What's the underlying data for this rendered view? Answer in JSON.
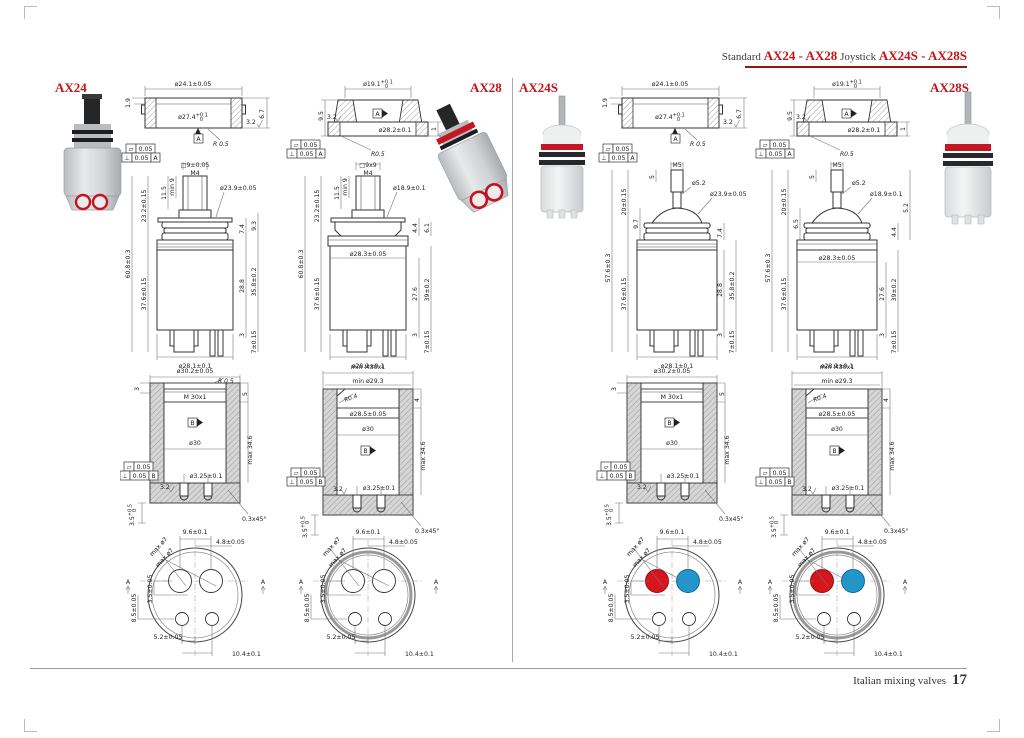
{
  "header": {
    "label_standard": "Standard",
    "models_standard": "AX24 - AX28",
    "label_joystick": "Joystick",
    "models_joystick": "AX24S - AX28S",
    "accent_color": "#c31418",
    "rule_color": "#8e1a12"
  },
  "footer": {
    "text": "Italian mixing valves",
    "page_number": "17"
  },
  "colors": {
    "hot": "#d6161d",
    "cold": "#2196cc",
    "label_red": "#c31418"
  },
  "columns": [
    {
      "model": "AX24",
      "detail": {
        "top_dia": "ø24.1±0.05",
        "inner_dia": "ø27.4",
        "inner_tol_plus": "+0.1",
        "inner_tol_minus": "0",
        "lip": "1.9",
        "finish": "3.2",
        "height": "6.7",
        "radius": "R 0.5",
        "datum": "A",
        "flatness": "0.05",
        "perp": "0.05",
        "perp_ref": "A"
      },
      "side": {
        "stem": "□9±0.05",
        "thread": "M4",
        "min_len": "min 9",
        "stem_h": "11.5",
        "upper_h": "23.2±0.15",
        "total_h": "60.8±0.3",
        "body_h": "37.6±0.15",
        "collar_dia": "ø23.9±0.05",
        "c1": "7.4",
        "c2": "9.3",
        "b1": "28.8",
        "b2": "35.8±0.2",
        "p1": "3",
        "p2": "7±0.15",
        "base_dia": "ø28.1±0.1"
      },
      "section": {
        "top_dia": "ø30.2±0.05",
        "radius": "R 0.5",
        "lip": "3",
        "thread": "M 30x1",
        "thread_h": "5",
        "datum": "B",
        "bore": "ø30",
        "depth": "max 34.6",
        "flatness": "0.05",
        "perp": "0.05",
        "perp_ref": "B",
        "finish": "3.2",
        "holes": "ø3.25±0.1",
        "chamfer": "0.3x45°",
        "foot": "3.5",
        "foot_tol_plus": "+0.5",
        "foot_tol_minus": "0"
      },
      "bottom": {
        "pitch": "9.6±0.1",
        "half_pitch": "4.8±0.05",
        "hole1": "max ø7",
        "hole2": "max ø7",
        "v1": "3.5±0.05",
        "v2": "8.5±0.05",
        "w1": "5.2±0.05",
        "w2": "10.4±0.1",
        "section_left": "A",
        "section_right": "A"
      }
    },
    {
      "model": "AX28",
      "detail": {
        "top_dia": "ø19.1",
        "top_tol_plus": "+0.1",
        "top_tol_minus": "0",
        "height": "9.5",
        "finish": "3.2",
        "datum": "A",
        "base_dia": "ø28.2±0.1",
        "edge": "1",
        "radius": "R0.5",
        "flatness": "0.05",
        "perp": "0.05",
        "perp_ref": "A"
      },
      "side": {
        "stem": "□9x9",
        "thread": "M4",
        "min_len": "min 9",
        "stem_h": "11.5",
        "upper_h": "23.2±0.15",
        "total_h": "60.8±0.3",
        "body_h": "37.6±0.15",
        "collar_dia": "ø18.9±0.1",
        "c1": "6.1",
        "c2": "4.4",
        "body_dia": "ø28.3±0.05",
        "b1": "27.6",
        "b2": "39±0.2",
        "p1": "3",
        "p2": "7±0.15",
        "base_dia": "ø28.1±0.1"
      },
      "section": {
        "top_thread": "min M30x1",
        "top_dia": "min ø29.3",
        "radius": "R0.4",
        "lip": "4",
        "counter_dia": "ø28.5±0.05",
        "bore": "ø30",
        "datum": "B",
        "depth": "max 34.6",
        "flatness": "0.05",
        "perp": "0.05",
        "perp_ref": "B",
        "finish": "3.2",
        "holes": "ø3.25±0.1",
        "chamfer": "0.3x45°",
        "foot": "3.5",
        "foot_tol_plus": "+0.5",
        "foot_tol_minus": "0"
      },
      "bottom": {
        "pitch": "9.6±0.1",
        "half_pitch": "4.8±0.05",
        "hole1": "max ø7",
        "hole2": "max ø7",
        "v1": "3.5±0.05",
        "v2": "8.5±0.05",
        "w1": "5.2±0.05",
        "w2": "10.4±0.1",
        "section_left": "A",
        "section_right": "A"
      }
    },
    {
      "model": "AX24S",
      "detail": {
        "top_dia": "ø24.1±0.05",
        "inner_dia": "ø27.4",
        "inner_tol_plus": "+0.1",
        "inner_tol_minus": "0",
        "lip": "1.9",
        "finish": "3.2",
        "height": "6.7",
        "radius": "R 0.5",
        "datum": "A",
        "flatness": "0.05",
        "perp": "0.05",
        "perp_ref": "A"
      },
      "side": {
        "thread": "M5",
        "stem_h": "5",
        "stem_dia": "ø5.2",
        "collar_dia": "ø23.9±0.05",
        "upper_h": "20±0.15",
        "mid_h": "9.7",
        "total_h": "57.6±0.3",
        "body_h": "37.6±0.15",
        "c1": "7.4",
        "b1": "28.8",
        "b2": "35.8±0.2",
        "p1": "3",
        "p2": "7±0.15",
        "base_dia": "ø28.1±0.1"
      },
      "section": {
        "top_dia": "ø30.2±0.05",
        "lip": "3",
        "thread": "M 30x1",
        "thread_h": "5",
        "datum": "B",
        "bore": "ø30",
        "depth": "max 34.6",
        "flatness": "0.05",
        "perp": "0.05",
        "perp_ref": "B",
        "finish": "3.2",
        "holes": "ø3.25±0.1",
        "chamfer": "0.3x45°",
        "foot": "3.5",
        "foot_tol_plus": "+0.5",
        "foot_tol_minus": "0"
      },
      "bottom": {
        "pitch": "9.6±0.1",
        "half_pitch": "4.8±0.05",
        "hole1": "max ø7",
        "hole2": "max ø7",
        "v1": "3.5±0.05",
        "v2": "8.5±0.05",
        "w1": "5.2±0.05",
        "w2": "10.4±0.1",
        "section_left": "A",
        "section_right": "A",
        "hot_hole": "red",
        "cold_hole": "blue"
      }
    },
    {
      "model": "AX28S",
      "detail": {
        "top_dia": "ø19.1",
        "top_tol_plus": "+0.1",
        "top_tol_minus": "0",
        "height": "9.5",
        "finish": "3.2",
        "datum": "A",
        "base_dia": "ø28.2±0.1",
        "edge": "1",
        "radius": "R0.5",
        "flatness": "0.05",
        "perp": "0.05",
        "perp_ref": "A"
      },
      "side": {
        "thread": "M5",
        "stem_h": "5",
        "stem_dia": "ø5.2",
        "collar_dia": "ø18.9±0.1",
        "upper_h": "20±0.15",
        "mid_h": "6.5",
        "total_h": "57.6±0.3",
        "body_h": "37.6±0.15",
        "c0": "5.2",
        "c2": "4.4",
        "body_dia": "ø28.3±0.05",
        "b1": "27.6",
        "b2": "39±0.2",
        "p1": "3",
        "p2": "7±0.15",
        "base_dia": "ø28.1±0.1"
      },
      "section": {
        "top_thread": "min M30x1",
        "top_dia": "min ø29.3",
        "radius": "R0.4",
        "lip": "4",
        "counter_dia": "ø28.5±0.05",
        "bore": "ø30",
        "datum": "B",
        "depth": "max 34.6",
        "flatness": "0.05",
        "perp": "0.05",
        "perp_ref": "B",
        "finish": "3.2",
        "holes": "ø3.25±0.1",
        "chamfer": "0.3x45°",
        "foot": "3.5",
        "foot_tol_plus": "+0.5",
        "foot_tol_minus": "0"
      },
      "bottom": {
        "pitch": "9.6±0.1",
        "half_pitch": "4.8±0.05",
        "hole1": "max ø7",
        "hole2": "max ø7",
        "v1": "3.5±0.05",
        "v2": "8.5±0.05",
        "w1": "5.2±0.05",
        "w2": "10.4±0.1",
        "section_left": "A",
        "section_right": "A",
        "hot_hole": "red",
        "cold_hole": "blue"
      }
    }
  ]
}
